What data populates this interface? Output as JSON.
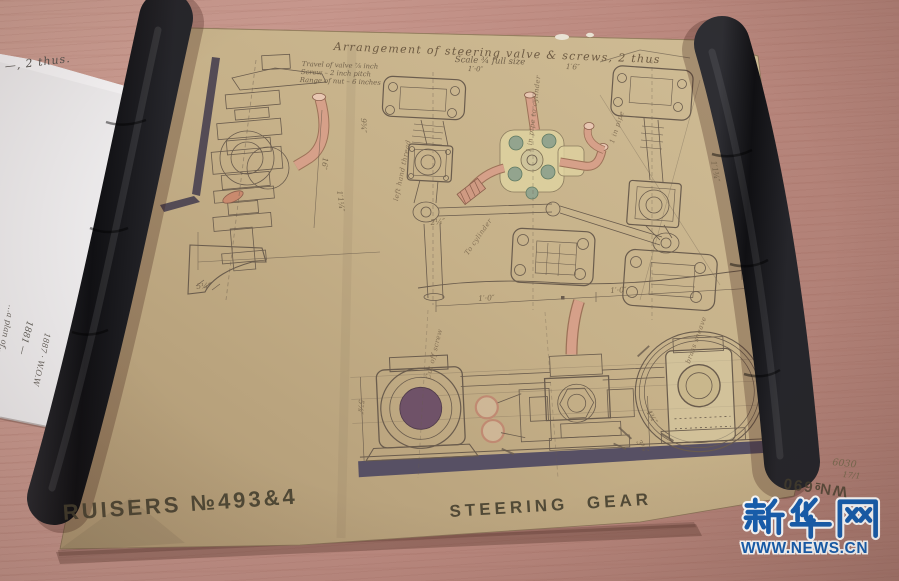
{
  "watermark": {
    "brand": "新华网",
    "site": "WWW.NEWS.CN",
    "blue": "#1660b2"
  },
  "drawing": {
    "title": "Arrangement of steering valve & screws, 2 thus",
    "scale": "Scale ¾ full size",
    "scale_sub": "1′·0″",
    "notes": [
      "Travel of valve ⅞ inch",
      "Screw – 2 inch pitch",
      "Range of nut – 6 inches"
    ],
    "stencil_series": "RUISERS №493&4",
    "stencil_title": "STEERING GEAR",
    "stencil_number": "W№690",
    "hand_number": "6030",
    "hand_date": "17/1",
    "annotations": {
      "left_hand_thread": "left hand thread",
      "to_cylinder": "To cylinder",
      "pipe_to_cylinder": "1 in pipe to cylinder",
      "pipe_right": "1 in pipe",
      "cut_off": "Cut off screw",
      "sheave": "brass sheave"
    },
    "dims": {
      "d16": "16″",
      "d5q": "5¼″",
      "dft1": "1′·0″",
      "dft2": "1′·0″",
      "d9t": "9¾″",
      "d11q": "1′1¼″",
      "d11t": "1′1¾″",
      "d5e": "5⅞″",
      "d4t": "4¾″",
      "d3e": "3⅜″",
      "d2q": "2¼″",
      "d16t": "1′6″"
    }
  },
  "side_paper": {
    "top_fragment": "—, 2 thus.",
    "rot_fragment1": "…a plan of…",
    "rot_fragment2": "1881 —",
    "rot_fragment3": "1887 · W.O.W"
  }
}
